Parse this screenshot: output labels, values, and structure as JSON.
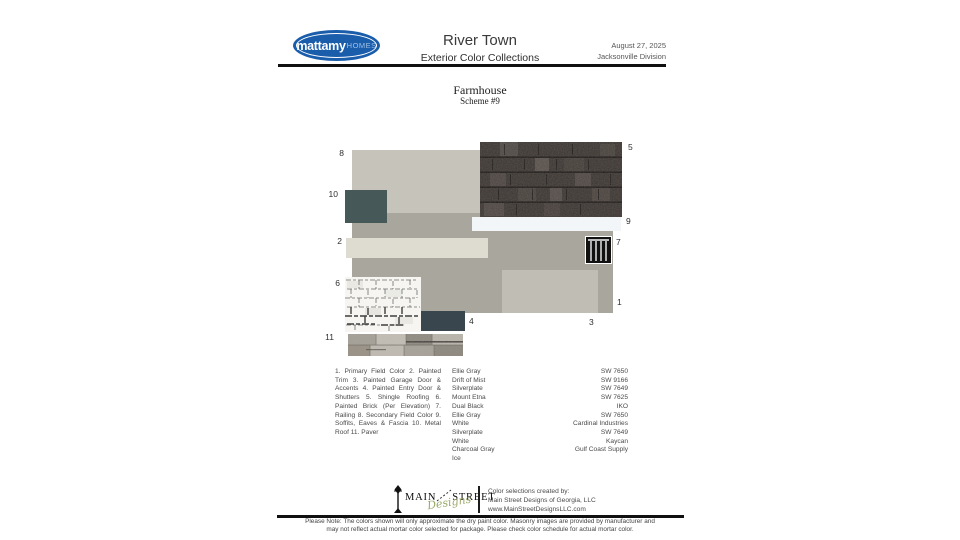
{
  "header": {
    "brand": "mattamy",
    "brand_suffix": "HOMES",
    "title": "River Town",
    "subtitle": "Exterior Color Collections",
    "date": "August 27, 2025",
    "division": "Jacksonville Division"
  },
  "scheme": {
    "style": "Farmhouse",
    "number": "Scheme #9"
  },
  "collage": {
    "numbers": {
      "n1": "1",
      "n2": "2",
      "n3": "3",
      "n4": "4",
      "n5": "5",
      "n6": "6",
      "n7": "7",
      "n8": "8",
      "n9": "9",
      "n10": "10",
      "n11": "11"
    },
    "colors": {
      "primary_field": "#a9a69e",
      "secondary_field": "#c6c3ba",
      "painted_trim": "#dedbd0",
      "garage_door": "#c0bdb5",
      "entry_door_shutters": "#3a464d",
      "shingle_roofing_base": "#3a3431",
      "painted_brick": "#f6f5f1",
      "railing": "#111111",
      "secondary_field_color": "#c6c3ba",
      "soffits_eaves_fascia": "#f2f6f9",
      "metal_roof": "#475859",
      "paver_base": "#b1ada4",
      "brand_blue": "#1a5dab",
      "logo_script_green": "#8a9a50"
    }
  },
  "legend": {
    "description": "1. Primary Field Color 2. Painted Trim 3. Painted Garage Door & Accents 4. Painted Entry Door & Shutters 5. Shingle Roofing 6. Painted Brick (Per Elevation) 7. Railing 8. Secondary Field Color 9. Soffits, Eaves & Fascia 10. Metal Roof 11. Paver",
    "rows": [
      {
        "name": "Ellie Gray",
        "code": "SW 7650"
      },
      {
        "name": "Drift of Mist",
        "code": "SW 9166"
      },
      {
        "name": "Silverplate",
        "code": "SW 7649"
      },
      {
        "name": "Mount Etna",
        "code": "SW 7625"
      },
      {
        "name": "Dual Black",
        "code": "IKO"
      },
      {
        "name": "Ellie Gray",
        "code": "SW 7650"
      },
      {
        "name": "White",
        "code": "Cardinal Industries"
      },
      {
        "name": "Silverplate",
        "code": "SW 7649"
      },
      {
        "name": "White",
        "code": "Kaycan"
      },
      {
        "name": "Charcoal Gray",
        "code": "Gulf Coast Supply"
      },
      {
        "name": "Ice",
        "code": ""
      }
    ]
  },
  "footer": {
    "logo_word1": "MAIN",
    "logo_word2": "STREET",
    "logo_script": "Designs",
    "credit_line1": "Color selections created by:",
    "credit_line2": "Main Street Designs of Georgia, LLC",
    "credit_line3": "www.MainStreetDesignsLLC.com",
    "note_line1": "Please Note: The colors shown will only approximate the dry paint color. Masonry images are provided by manufacturer and",
    "note_line2": "may not reflect actual mortar color selected for package. Please check color schedule for actual mortar color."
  }
}
